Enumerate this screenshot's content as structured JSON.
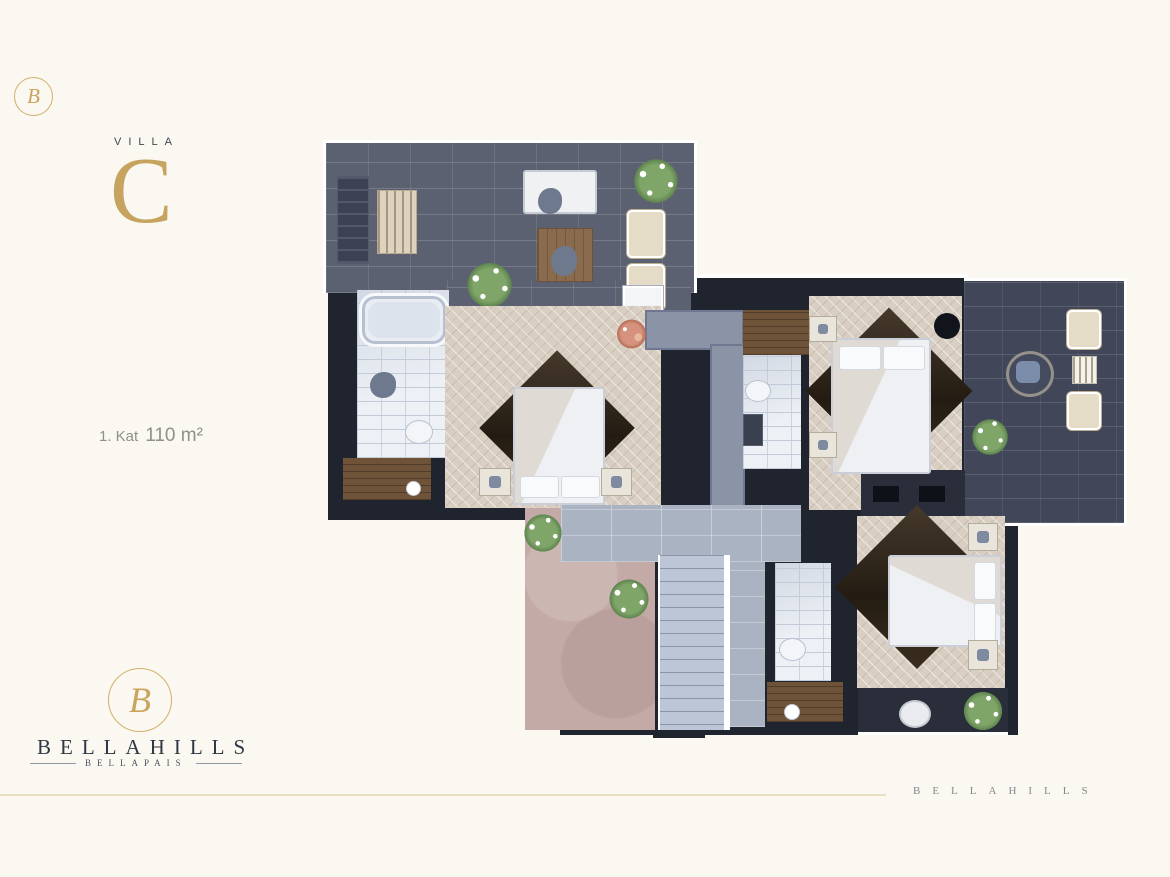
{
  "palette": {
    "background": "#fbf8f1",
    "gold": "#c6a45f",
    "gold_line": "#e8e0c1",
    "dark_text": "#2e3742",
    "gray_text": "#8f8f8c",
    "wall": "#20242e",
    "terrace_paver": "#5b6170",
    "terrace_paver_dark": "#414759",
    "bathroom_tile": "#edf0f5",
    "parquet": "#d9cec2",
    "rug": "#2e2418",
    "stairs": "#bcc6d6",
    "ground": "#c3aaa6",
    "plant_green": "#7fa569"
  },
  "header": {
    "monogram": "B",
    "villa_label": "VILLA",
    "villa_letter": "C"
  },
  "floor_info": {
    "prefix": "1. Kat",
    "area": "110 m²"
  },
  "brand_block": {
    "monogram": "B",
    "name": "BELLAHILLS",
    "subtitle": "BELLAPAIS"
  },
  "footer": {
    "brand": "BELLAHILLS"
  }
}
